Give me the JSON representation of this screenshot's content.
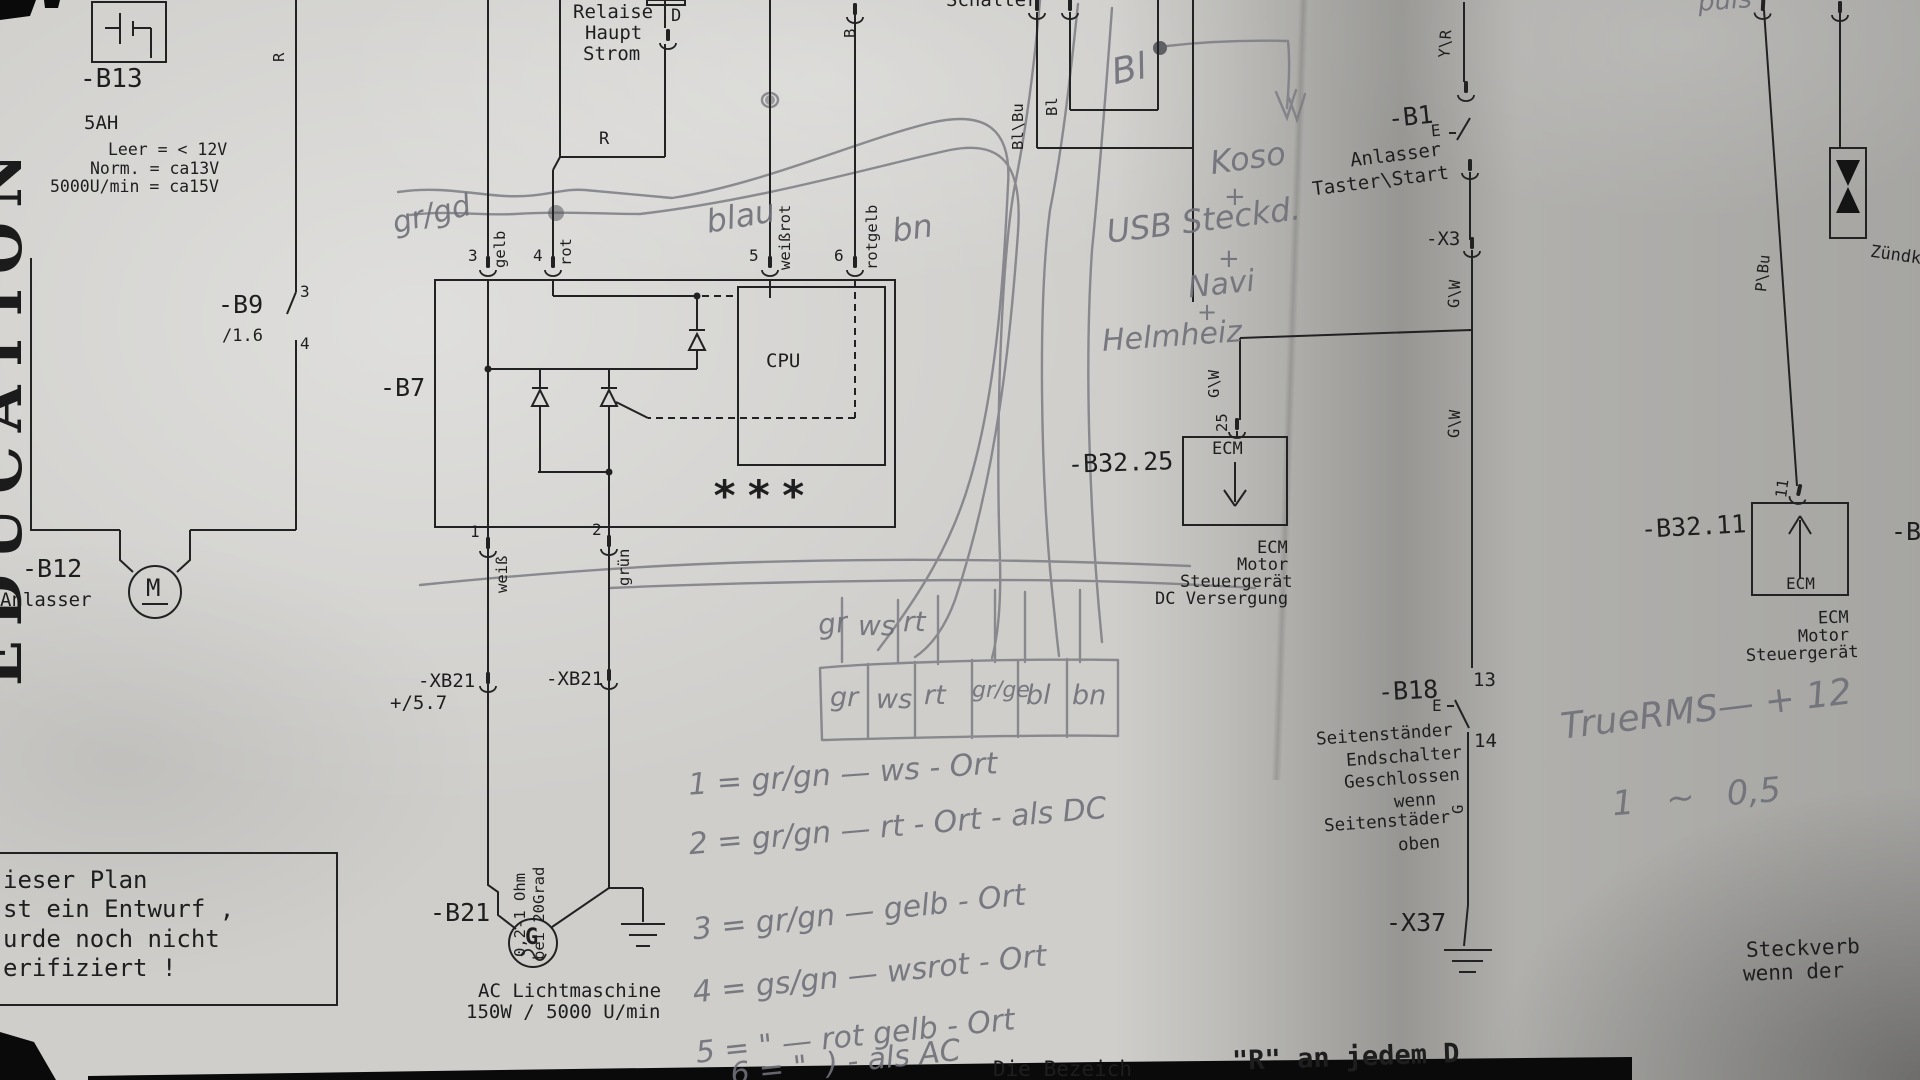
{
  "colors": {
    "paper": "#cfcecb",
    "ink": "#1e1e1e",
    "pencil": "#6f6f78",
    "black_bar": "#0a0a0a"
  },
  "watermark": "EDUCATION",
  "battery": {
    "id": "-B13",
    "capacity": "5AH",
    "spec1": "Leer = < 12V",
    "spec2": "Norm. = ca13V",
    "spec3": "5000U/min = ca15V",
    "wire": "R"
  },
  "b9": {
    "id": "-B9",
    "ref": "/1.6",
    "pin3": "3",
    "pin4": "4"
  },
  "b12": {
    "id": "-B12",
    "name": "Anlasser",
    "motor": "M"
  },
  "relay": {
    "line1": "Relaise",
    "line2": "Haupt",
    "line3": "Strom",
    "pin": "D",
    "wire": "R"
  },
  "b7": {
    "id": "-B7",
    "cpu": "CPU",
    "stars": "***",
    "wireB": "B",
    "pin3": "3",
    "c3": "gelb",
    "pin4": "4",
    "c4": "rot",
    "pin5": "5",
    "c5": "weißrot",
    "pin6": "6",
    "c6": "rotgelb",
    "pin1": "1",
    "c1": "weiß",
    "pin2": "2",
    "c2": "grün"
  },
  "xb21": {
    "l": "-XB21",
    "r": "-XB21",
    "ref": "+/5.7"
  },
  "gen": {
    "id": "-B21",
    "g": "G",
    "ohm": "0,2-1 Ohm",
    "grad": "bei 20Grad",
    "cap1": "AC Lichtmaschine",
    "cap2": "150W / 5000 U/min"
  },
  "note": {
    "l1": "ieser Plan",
    "l2": "st ein Entwurf ,",
    "l3": "urde noch nicht",
    "l4": "erifiziert !"
  },
  "sw": {
    "title": "Schalter",
    "w1": "Bl\\Bu",
    "w2": "Bl"
  },
  "b1": {
    "id": "-B1",
    "e": "E",
    "l1": "Anlasser",
    "l2": "Taster\\Start",
    "x3": "-X3",
    "yr": "Y\\R",
    "gw1": "G\\W",
    "gw2": "G\\W",
    "gw3": "G\\W"
  },
  "ecm25": {
    "id": "-B32.25",
    "pin": "25",
    "box": "ECM",
    "l1": "ECM",
    "l2": "Motor",
    "l3": "Steuergerät",
    "l4": "DC Versergung"
  },
  "b18": {
    "id": "-B18",
    "p13": "13",
    "p14": "14",
    "e": "E",
    "g": "G",
    "l1": "Seitenständer",
    "l2": "Endschalter",
    "l3": "Geschlossen",
    "l4": "wenn",
    "l5": "Seitenstäder",
    "l6": "oben",
    "x37": "-X37"
  },
  "ecm11": {
    "id": "-B32.11",
    "pin": "11",
    "pbu": "P\\Bu",
    "box": "ECM",
    "l1": "ECM",
    "l2": "Motor",
    "l3": "Steuergerät",
    "cut": "-B3"
  },
  "spark": {
    "label": "Zündke"
  },
  "bottom": {
    "t1": "Die Bezeich",
    "t2": "\"R\" an jedem D",
    "s1": "Steckverb",
    "s2": "wenn der"
  },
  "hw": {
    "grgd": "gr/gd",
    "blau": "blau",
    "bn": "bn",
    "bl": "Bl",
    "puls": "puls",
    "koso": "Koso",
    "p1": "+",
    "usb": "USB Steckd.",
    "p2": "+",
    "navi": "Navi",
    "p3": "+",
    "helm": "Helmheiz",
    "a1": "gr",
    "a2": "ws",
    "a3": "rt",
    "c1": "gr",
    "c2": "ws",
    "c3": "rt",
    "c4": "gr/ge",
    "c5": "bl",
    "c6": "bn",
    "n1": "1 = gr/gn — ws - Ort",
    "n2": "2 = gr/gn — rt - Ort - als DC",
    "n3": "3 = gr/gn — gelb - Ort",
    "n4": "4 = gs/gn — wsrot - Ort",
    "n5": "5 = \" — rot gelb - Ort",
    "n6": "6 = \"  ) - als AC",
    "rms1": "TrueRMS— + 12",
    "rms2": "1   ∼   0,5"
  }
}
